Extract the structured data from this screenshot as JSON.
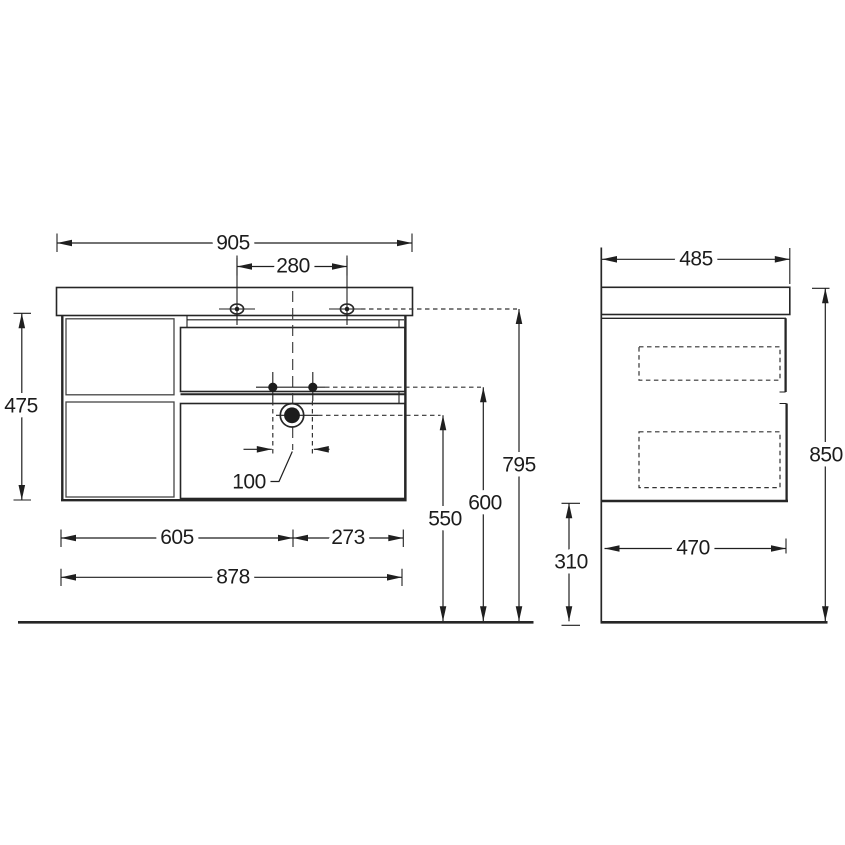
{
  "drawing": {
    "title": "vanity-unit-dimension-drawing",
    "line_color": "#262626",
    "background": "#ffffff",
    "front_view": {
      "dimensions": {
        "countertop_width": "905",
        "faucet_hole_spacing": "280",
        "cabinet_height": "475",
        "drain_offset": "100",
        "left_section_width": "605",
        "right_section_width": "273",
        "cabinet_width": "878",
        "drain_height": "550",
        "supply_holes_height": "600",
        "worktop_underside_height": "795"
      }
    },
    "side_view": {
      "dimensions": {
        "countertop_depth": "485",
        "overall_height": "850",
        "floor_clearance": "310",
        "cabinet_depth": "470"
      }
    }
  }
}
